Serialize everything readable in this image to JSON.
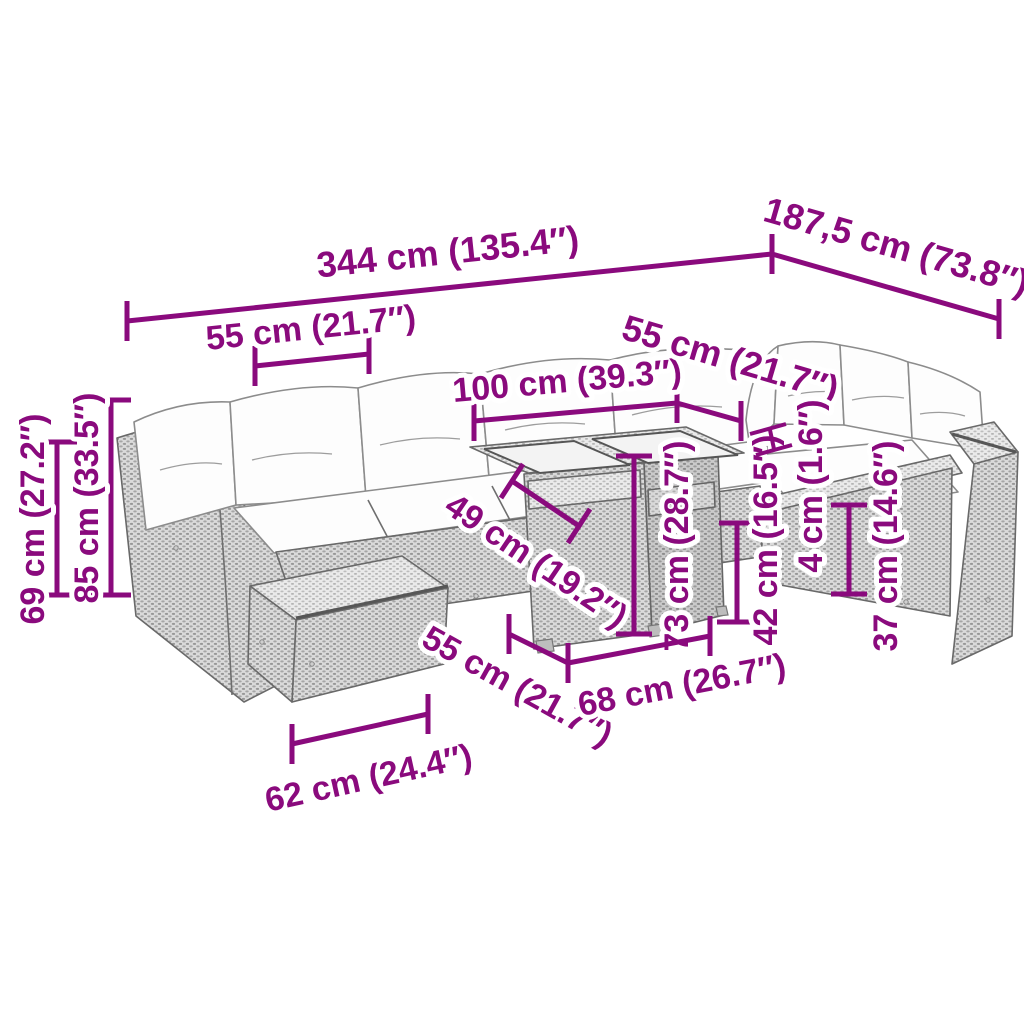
{
  "diagram": {
    "type": "furniture-dimension-diagram",
    "subject": "garden lounge sofa set with cube table",
    "accent_color": "#8a0a7d",
    "line_art_color": "#6e6e6e",
    "background_color": "#ffffff",
    "dimensions": {
      "overall_width": "344 cm (135.4″)",
      "overall_depth": "187,5 cm (73.8″)",
      "left_seat_width": "55 cm (21.7″)",
      "table_length": "100 cm (39.3″)",
      "right_seat_width": "55 cm (21.7″)",
      "back_height": "69 cm (27.2″)",
      "total_height": "85 cm (33.5″)",
      "seat_depth": "49 cm (19.2″)",
      "table_height": "73 cm (28.7″)",
      "seat_height": "42 cm (16.5″)",
      "tabletop_thickness": "4 cm (1.6″)",
      "armrest_height": "37 cm (14.6″)",
      "table_depth": "55 cm (21.7″)",
      "table_base_width": "68 cm (26.7″)",
      "armrest_module_width": "62 cm (24.4″)"
    }
  }
}
